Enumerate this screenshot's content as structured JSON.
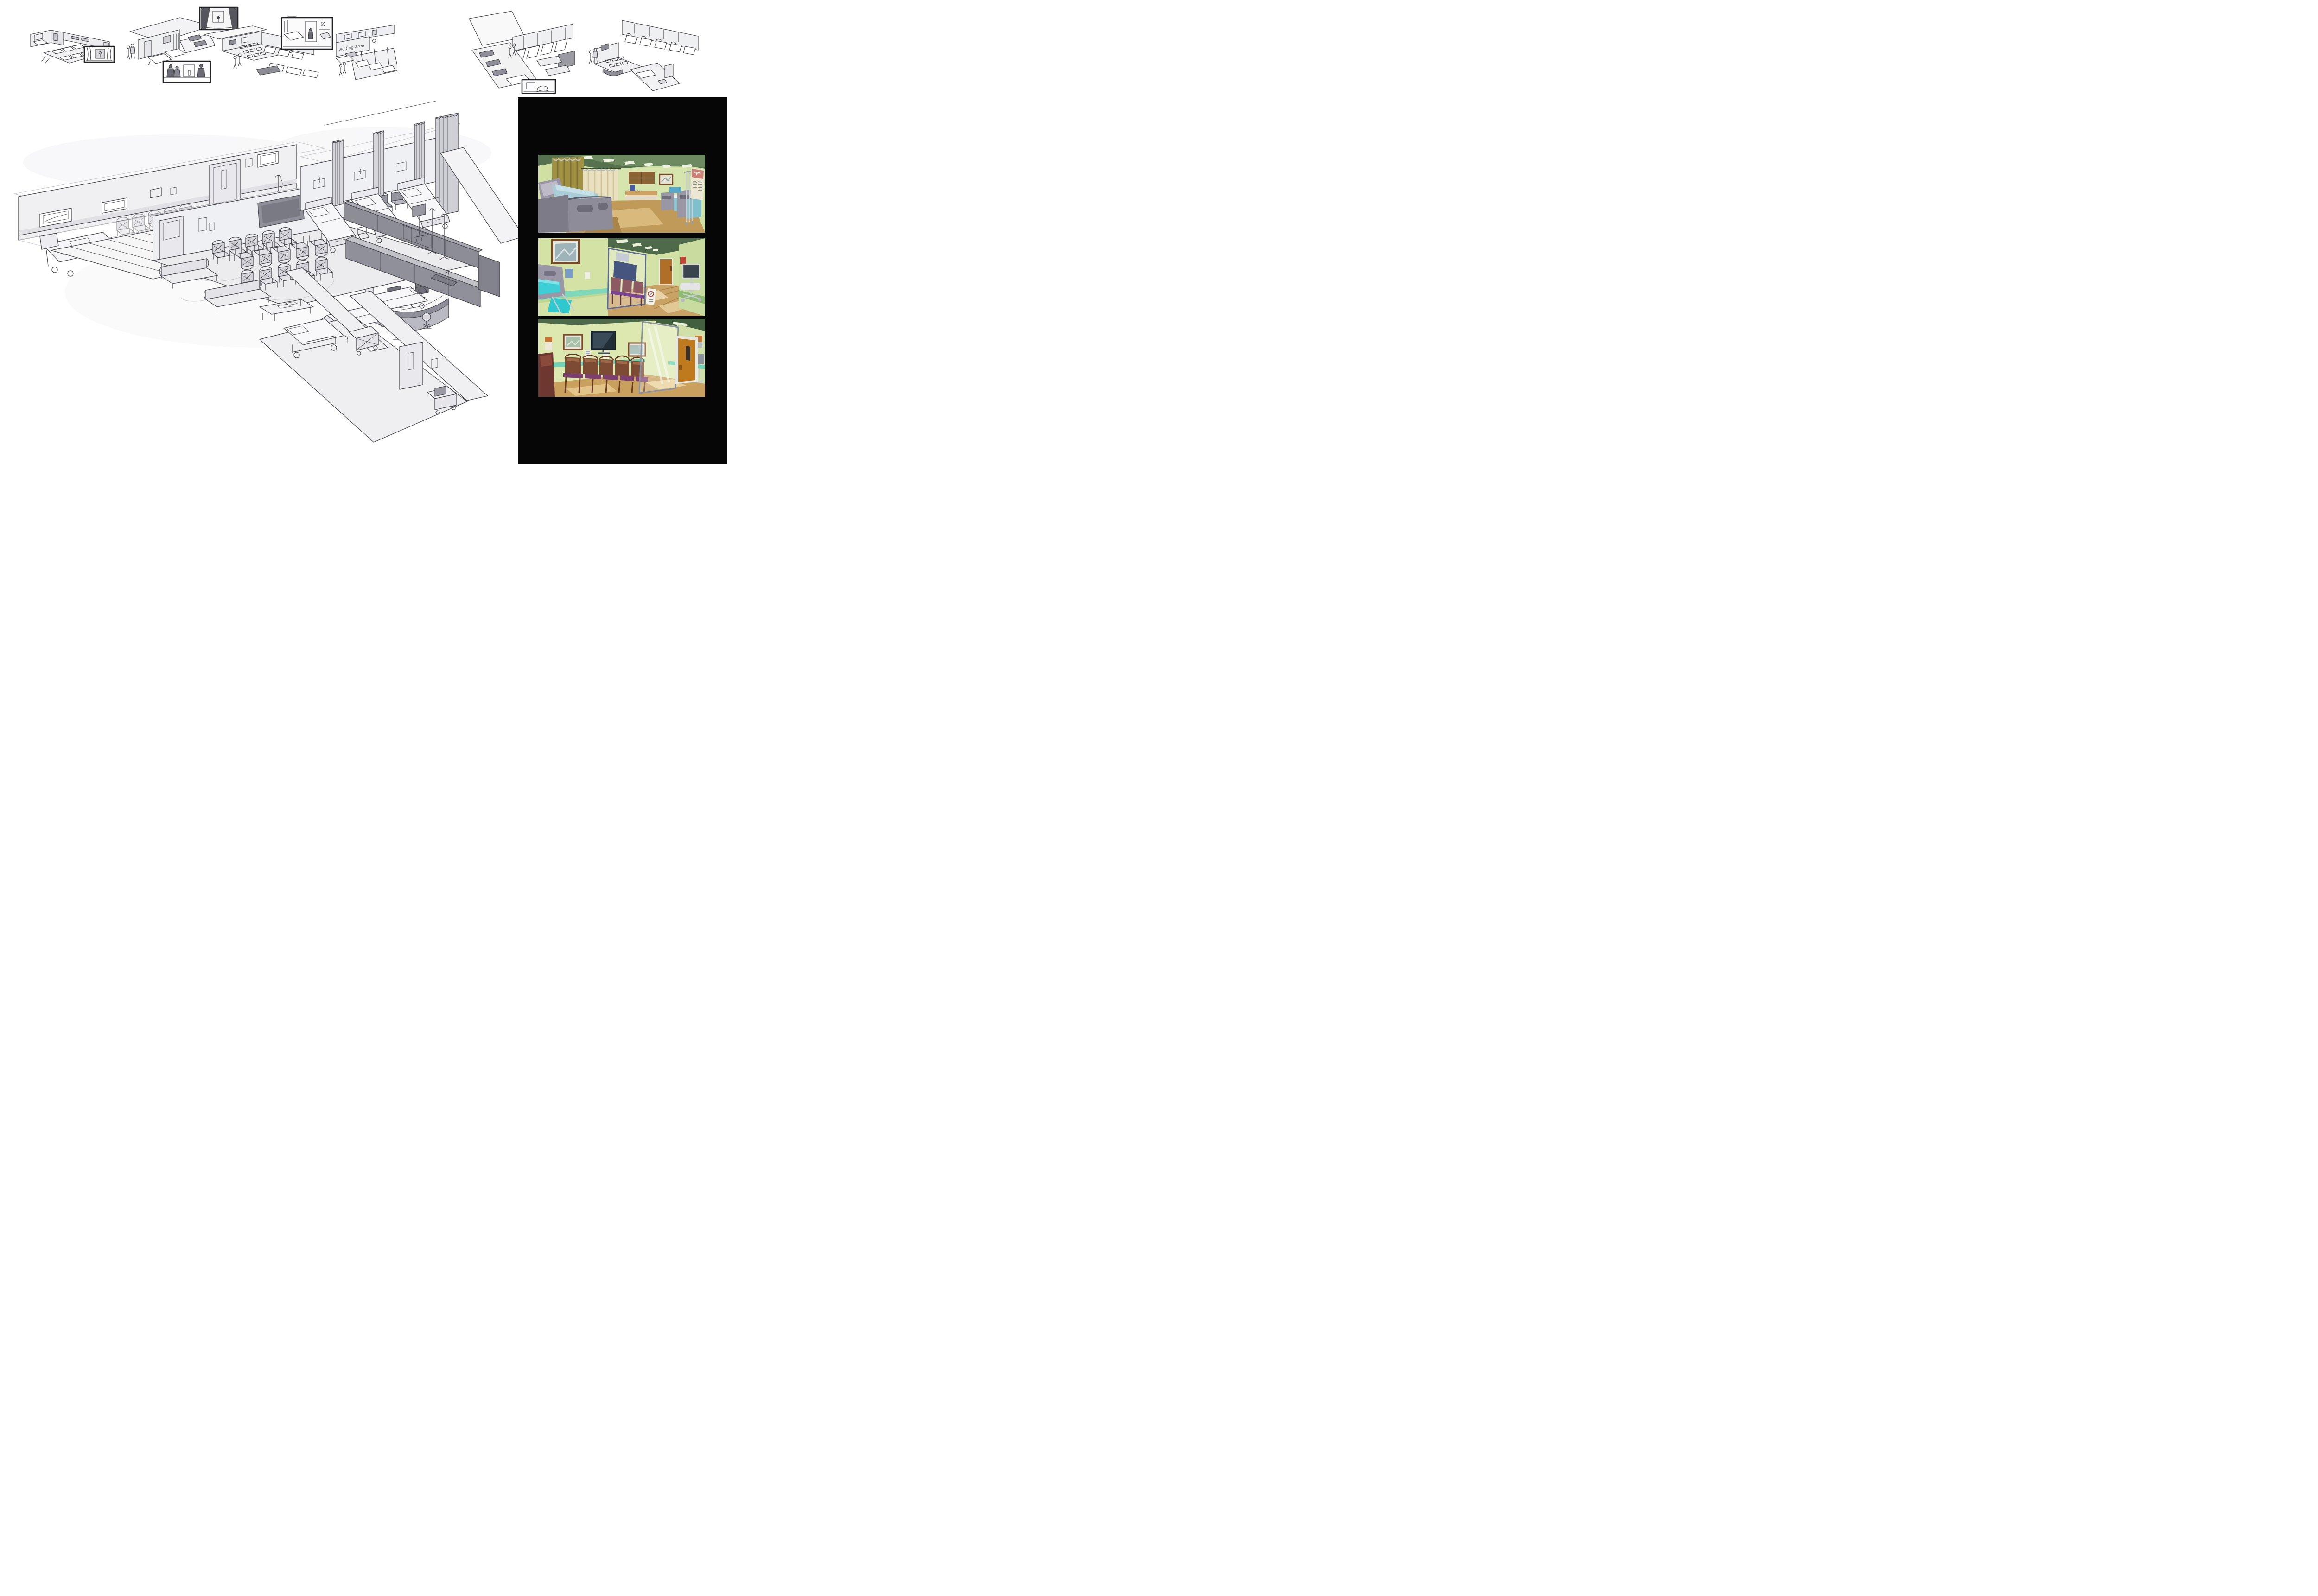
{
  "board": {
    "background_color": "#ffffff",
    "media": "hospital interior concept-art sheet",
    "sections": [
      "thumbnail-sketches",
      "main-isometric-sketch",
      "color-studies"
    ]
  },
  "thumbnails": [
    {
      "name": "thumbnail-1",
      "description": "isometric sketch of exam room, corridor and six-bed ward with a small framed vignette inset"
    },
    {
      "name": "thumbnail-2",
      "description": "isometric cutaway of patient rooms with two standing figures and a storyboard inset of a corridor with people"
    },
    {
      "name": "thumbnail-3",
      "description": "isometric waiting room and bed ward with a dark storyboard vignette of a curtained bay"
    },
    {
      "name": "thumbnail-4",
      "description": "isometric cutaway labelled waiting area with curtained ward beds and a patient-room vignette inset",
      "annotation": "waiting area"
    },
    {
      "name": "thumbnail-5",
      "description": "isometric four-bed curtained ward beside a corridor with benches, plus a small bed vignette inset"
    },
    {
      "name": "thumbnail-6",
      "description": "isometric cutaway of waiting room, reception desk, curtained bed bays and corridor with two figures"
    }
  ],
  "main_sketch": {
    "name": "hospital-wing-cutaway",
    "description": "large isometric line drawing of a hospital wing",
    "rooms": [
      "long corridor with windows, framed pictures and a door",
      "side room with hatched floor",
      "waiting room",
      "six-bed ward with privacy curtains",
      "service corridor"
    ],
    "furniture": [
      "hospital bed",
      "row of five corridor chairs",
      "wall-mounted TV",
      "two rows of waiting chairs",
      "two sofas",
      "coffee table with magazines",
      "curved reception desk with two monitors and two stools",
      "three curtained ward beds",
      "two open ward beds",
      "privacy curtains",
      "IV poles",
      "monitor cart",
      "storage cabinets with sink counter",
      "gurney",
      "laundry cart",
      "utility cart"
    ]
  },
  "color_studies": {
    "panel_background": "#060606",
    "studies": [
      {
        "name": "ward-color-study",
        "subject": "patient ward with beds, privacy curtains, wood cabinets, sink counter, IV stand and wall poster",
        "palette": {
          "ceiling_green": "#55714e",
          "wall_green": "#d6e4ae",
          "curtain_olive": "#a19143",
          "curtain_cream": "#e9e0bf",
          "bed_frame_gray": "#8f8c9a",
          "bedding_blue": "#a9ccd6",
          "floor_wood": "#bf9a58",
          "cabinet_wood": "#8a6435",
          "poster_red": "#cb8176"
        }
      },
      {
        "name": "corridor-color-study",
        "subject": "hallway with patient bed, glass partition, mauve waiting chairs, floor sign, monitor cart and far door",
        "palette": {
          "wall_green": "#d4e2a6",
          "wainscot_teal": "#7fd8ba",
          "blanket_teal": "#3ecfd6",
          "chair_mauve": "#8d5a64",
          "seat_purple": "#7a4490",
          "floor_wood": "#c9a266",
          "door_wood": "#b06f28",
          "ceiling_green": "#4e6a4a"
        }
      },
      {
        "name": "waiting-room-color-study",
        "subject": "waiting room with rows of wooden chairs, wall TV, framed pictures, glass partition and orange door",
        "palette": {
          "wall_green": "#dce8b0",
          "rail_teal": "#72d0b4",
          "chair_brown": "#7d4a33",
          "seat_purple": "#7c3f6e",
          "sofa_maroon": "#6e3830",
          "door_orange": "#c07a1e",
          "tv_dark": "#222e38",
          "floor_wood": "#c9a05e"
        }
      }
    ]
  }
}
